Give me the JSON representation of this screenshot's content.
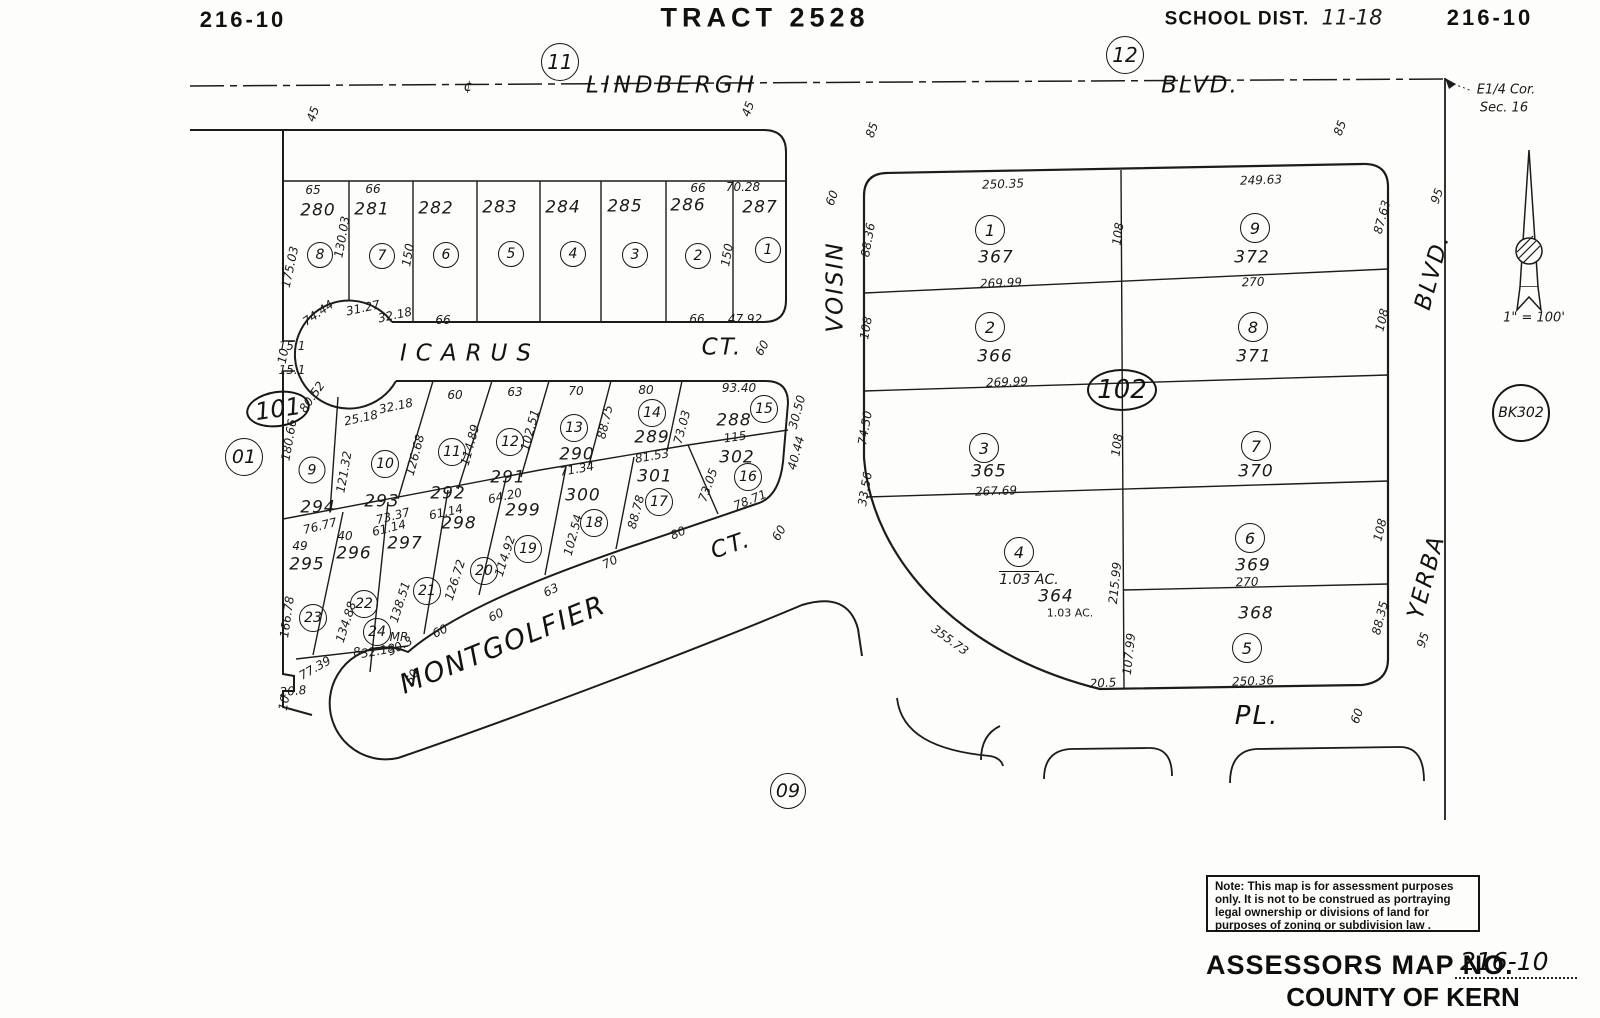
{
  "note_box": {
    "text": "Note: This map is for assessment purposes\nonly. It is not to be construed as portraying\nlegal ownership or divisions of land for\npurposes of zoning or subdivision law ."
  },
  "footer": {
    "assessors_label": "ASSESSORS MAP NO.",
    "map_no": "216-10",
    "county": "COUNTY OF KERN"
  },
  "annotations": [
    {
      "t": "216-10",
      "x": 243,
      "y": 20,
      "c": "hdr",
      "n": "sheet-number-left"
    },
    {
      "t": "TRACT 2528",
      "x": 765,
      "y": 18,
      "c": "hdr",
      "s": 27,
      "ls": 5,
      "n": "tract-title"
    },
    {
      "t": "SCHOOL DIST.",
      "x": 1237,
      "y": 19,
      "c": "hdr",
      "s": 19,
      "ls": 1,
      "n": "school-district-label"
    },
    {
      "t": "11-18",
      "x": 1352,
      "y": 18,
      "c": "hw",
      "n": "school-district-value"
    },
    {
      "t": "216-10",
      "x": 1490,
      "y": 18,
      "c": "hdr",
      "n": "sheet-number-right"
    },
    {
      "t": "E1/4 Cor.",
      "x": 1506,
      "y": 90,
      "c": "it13",
      "n": "corner-note-line1"
    },
    {
      "t": "Sec. 16",
      "x": 1504,
      "y": 108,
      "c": "it13",
      "n": "corner-note-line2"
    },
    {
      "t": "1\" = 100'",
      "x": 1534,
      "y": 318,
      "c": "it13",
      "n": "scale-note"
    },
    {
      "t": "LINDBERGH",
      "x": 672,
      "y": 86,
      "c": "st",
      "ls": 4,
      "n": "street-lindbergh"
    },
    {
      "t": "BLVD.",
      "x": 1200,
      "y": 86,
      "c": "st",
      "n": "street-lindbergh-blvd"
    },
    {
      "t": "¢",
      "x": 468,
      "y": 87,
      "c": "it14",
      "n": "centerline-symbol"
    },
    {
      "t": "ICARUS",
      "x": 470,
      "y": 354,
      "c": "st",
      "ls": 9,
      "n": "street-icarus"
    },
    {
      "t": "CT.",
      "x": 722,
      "y": 348,
      "c": "st",
      "n": "street-icarus-ct"
    },
    {
      "t": "MONTGOLFIER",
      "x": 503,
      "y": 645,
      "r": -22,
      "c": "st",
      "s": 27,
      "ls": 2,
      "n": "street-montgolfier"
    },
    {
      "t": "CT.",
      "x": 731,
      "y": 546,
      "r": -19,
      "c": "st",
      "n": "street-montgolfier-ct"
    },
    {
      "t": "VOISIN",
      "x": 836,
      "y": 287,
      "r": -90,
      "c": "st",
      "n": "street-voisin"
    },
    {
      "t": "YERBA",
      "x": 1427,
      "y": 577,
      "r": -75,
      "c": "st",
      "n": "street-yerba"
    },
    {
      "t": "BLVD.",
      "x": 1433,
      "y": 272,
      "r": -75,
      "c": "st",
      "n": "street-yerba-blvd"
    },
    {
      "t": "PL.",
      "x": 1257,
      "y": 716,
      "c": "st",
      "s": 26,
      "n": "street-pl"
    },
    {
      "t": "45",
      "x": 313,
      "y": 114,
      "r": -70
    },
    {
      "t": "45",
      "x": 748,
      "y": 109,
      "r": -70
    },
    {
      "t": "85",
      "x": 872,
      "y": 130,
      "r": -70
    },
    {
      "t": "85",
      "x": 1340,
      "y": 128,
      "r": -70
    },
    {
      "t": "95",
      "x": 1437,
      "y": 196,
      "r": -70
    },
    {
      "t": "95",
      "x": 1423,
      "y": 640,
      "r": -70
    },
    {
      "t": "60",
      "x": 832,
      "y": 198,
      "r": -70
    },
    {
      "t": "60",
      "x": 762,
      "y": 348,
      "r": -60
    },
    {
      "t": "60",
      "x": 779,
      "y": 533,
      "r": -60
    },
    {
      "t": "60",
      "x": 1357,
      "y": 716,
      "r": -70
    },
    {
      "t": "65",
      "x": 313,
      "y": 190
    },
    {
      "t": "66",
      "x": 373,
      "y": 189
    },
    {
      "t": "66",
      "x": 698,
      "y": 188
    },
    {
      "t": "70.28",
      "x": 743,
      "y": 187
    },
    {
      "t": "175.03",
      "x": 290,
      "y": 267,
      "r": -78
    },
    {
      "t": "130.03",
      "x": 342,
      "y": 237,
      "r": -80
    },
    {
      "t": "150",
      "x": 408,
      "y": 255,
      "r": -80
    },
    {
      "t": "150",
      "x": 727,
      "y": 255,
      "r": -80
    },
    {
      "t": "74.44",
      "x": 318,
      "y": 313,
      "r": -35
    },
    {
      "t": "31.27",
      "x": 363,
      "y": 308,
      "r": -12
    },
    {
      "t": "32.18",
      "x": 395,
      "y": 315,
      "r": -12
    },
    {
      "t": "66",
      "x": 443,
      "y": 320
    },
    {
      "t": "66",
      "x": 697,
      "y": 319
    },
    {
      "t": "47.92",
      "x": 745,
      "y": 319
    },
    {
      "t": "15.1",
      "x": 292,
      "y": 346
    },
    {
      "t": "10",
      "x": 283,
      "y": 356,
      "r": -80
    },
    {
      "t": "15.1",
      "x": 292,
      "y": 370
    },
    {
      "t": "80.52",
      "x": 312,
      "y": 397,
      "r": -55
    },
    {
      "t": "25.18",
      "x": 361,
      "y": 418,
      "r": -12
    },
    {
      "t": "32.18",
      "x": 396,
      "y": 406,
      "r": -12
    },
    {
      "t": "60",
      "x": 455,
      "y": 395
    },
    {
      "t": "63",
      "x": 515,
      "y": 392
    },
    {
      "t": "70",
      "x": 576,
      "y": 391
    },
    {
      "t": "80",
      "x": 646,
      "y": 390
    },
    {
      "t": "93.40",
      "x": 739,
      "y": 388
    },
    {
      "t": "180.66",
      "x": 289,
      "y": 440,
      "r": -80
    },
    {
      "t": "121.32",
      "x": 344,
      "y": 472,
      "r": -80
    },
    {
      "t": "126.68",
      "x": 415,
      "y": 455,
      "r": -75
    },
    {
      "t": "114.89",
      "x": 470,
      "y": 445,
      "r": -75
    },
    {
      "t": "102.51",
      "x": 530,
      "y": 430,
      "r": -75
    },
    {
      "t": "88.75",
      "x": 605,
      "y": 422,
      "r": -77
    },
    {
      "t": "73.03",
      "x": 682,
      "y": 427,
      "r": -75
    },
    {
      "t": "30.50",
      "x": 797,
      "y": 412,
      "r": -75
    },
    {
      "t": "40.44",
      "x": 796,
      "y": 453,
      "r": -75
    },
    {
      "t": "73.05",
      "x": 708,
      "y": 485,
      "r": -70
    },
    {
      "t": "88.78",
      "x": 636,
      "y": 512,
      "r": -75
    },
    {
      "t": "102.54",
      "x": 573,
      "y": 535,
      "r": -75
    },
    {
      "t": "114.92",
      "x": 505,
      "y": 556,
      "r": -72
    },
    {
      "t": "126.72",
      "x": 455,
      "y": 580,
      "r": -72
    },
    {
      "t": "138.51",
      "x": 400,
      "y": 602,
      "r": -72
    },
    {
      "t": "134.88",
      "x": 346,
      "y": 622,
      "r": -72
    },
    {
      "t": "166.78",
      "x": 287,
      "y": 617,
      "r": -82
    },
    {
      "t": "115",
      "x": 735,
      "y": 437,
      "r": -8
    },
    {
      "t": "81.53",
      "x": 652,
      "y": 456,
      "r": -10
    },
    {
      "t": "71.34",
      "x": 577,
      "y": 469,
      "r": -10
    },
    {
      "t": "64.20",
      "x": 505,
      "y": 496,
      "r": -12
    },
    {
      "t": "61.14",
      "x": 446,
      "y": 512,
      "r": -12
    },
    {
      "t": "73.37",
      "x": 393,
      "y": 516,
      "r": -14
    },
    {
      "t": "61.14",
      "x": 389,
      "y": 528,
      "r": -14
    },
    {
      "t": "76.77",
      "x": 320,
      "y": 526,
      "r": -14
    },
    {
      "t": "49",
      "x": 300,
      "y": 546
    },
    {
      "t": "40",
      "x": 345,
      "y": 536
    },
    {
      "t": "78.71",
      "x": 750,
      "y": 500,
      "r": -22
    },
    {
      "t": "80",
      "x": 678,
      "y": 533,
      "r": -24
    },
    {
      "t": "70",
      "x": 610,
      "y": 562,
      "r": -26
    },
    {
      "t": "63",
      "x": 551,
      "y": 590,
      "r": -26
    },
    {
      "t": "60",
      "x": 496,
      "y": 615,
      "r": -26
    },
    {
      "t": "60",
      "x": 440,
      "y": 631,
      "r": -26
    },
    {
      "t": "8",
      "x": 357,
      "y": 652,
      "r": -10
    },
    {
      "t": "32.18",
      "x": 378,
      "y": 651,
      "r": -10
    },
    {
      "t": "30.3",
      "x": 400,
      "y": 646,
      "r": -28
    },
    {
      "t": "77.39",
      "x": 315,
      "y": 668,
      "r": -30
    },
    {
      "t": "20.8",
      "x": 293,
      "y": 691,
      "r": -5
    },
    {
      "t": "10",
      "x": 284,
      "y": 703,
      "r": -80
    },
    {
      "t": "60",
      "x": 412,
      "y": 677,
      "r": -62
    },
    {
      "t": "MR",
      "x": 399,
      "y": 637,
      "c": "it12",
      "n": "mr-note"
    },
    {
      "t": "250.35",
      "x": 1003,
      "y": 184,
      "r": -2
    },
    {
      "t": "249.63",
      "x": 1261,
      "y": 180,
      "r": -2
    },
    {
      "t": "88.36",
      "x": 868,
      "y": 240,
      "r": -80
    },
    {
      "t": "108",
      "x": 866,
      "y": 328,
      "r": -80
    },
    {
      "t": "74.50",
      "x": 865,
      "y": 428,
      "r": -80
    },
    {
      "t": "33.56",
      "x": 865,
      "y": 489,
      "r": -80
    },
    {
      "t": "108",
      "x": 1118,
      "y": 234,
      "r": -82
    },
    {
      "t": "108",
      "x": 1117,
      "y": 445,
      "r": -82
    },
    {
      "t": "215.99",
      "x": 1115,
      "y": 583,
      "r": -84
    },
    {
      "t": "107.99",
      "x": 1129,
      "y": 654,
      "r": -84
    },
    {
      "t": "87.63",
      "x": 1382,
      "y": 217,
      "r": -75
    },
    {
      "t": "108",
      "x": 1382,
      "y": 320,
      "r": -76
    },
    {
      "t": "108",
      "x": 1380,
      "y": 530,
      "r": -76
    },
    {
      "t": "88.35",
      "x": 1380,
      "y": 618,
      "r": -76
    },
    {
      "t": "269.99",
      "x": 1001,
      "y": 283,
      "r": -2
    },
    {
      "t": "269.99",
      "x": 1007,
      "y": 382,
      "r": -2
    },
    {
      "t": "267.69",
      "x": 996,
      "y": 491,
      "r": -2
    },
    {
      "t": "270",
      "x": 1253,
      "y": 282,
      "r": -2
    },
    {
      "t": "270",
      "x": 1247,
      "y": 582,
      "r": -2
    },
    {
      "t": "355.73",
      "x": 950,
      "y": 640,
      "r": 36
    },
    {
      "t": "20.5",
      "x": 1103,
      "y": 683,
      "r": -3
    },
    {
      "t": "250.36",
      "x": 1253,
      "y": 681,
      "r": -2
    },
    {
      "t": "1.03 AC.",
      "x": 1029,
      "y": 580,
      "c": "it14",
      "n": "lot-364-acreage"
    },
    {
      "t": "1.03 AC.",
      "x": 1070,
      "y": 613,
      "c": "pl11",
      "n": "lot-364-acreage-2"
    },
    {
      "t": "280",
      "x": 318,
      "y": 211,
      "c": "lot"
    },
    {
      "t": "281",
      "x": 372,
      "y": 210,
      "c": "lot"
    },
    {
      "t": "282",
      "x": 436,
      "y": 209,
      "c": "lot"
    },
    {
      "t": "283",
      "x": 500,
      "y": 208,
      "c": "lot"
    },
    {
      "t": "284",
      "x": 563,
      "y": 208,
      "c": "lot"
    },
    {
      "t": "285",
      "x": 625,
      "y": 207,
      "c": "lot"
    },
    {
      "t": "286",
      "x": 688,
      "y": 206,
      "c": "lot"
    },
    {
      "t": "287",
      "x": 760,
      "y": 208,
      "c": "lot"
    },
    {
      "t": "294",
      "x": 318,
      "y": 508,
      "c": "lot"
    },
    {
      "t": "293",
      "x": 382,
      "y": 502,
      "c": "lot"
    },
    {
      "t": "292",
      "x": 448,
      "y": 494,
      "c": "lot"
    },
    {
      "t": "291",
      "x": 508,
      "y": 478,
      "c": "lot"
    },
    {
      "t": "290",
      "x": 577,
      "y": 455,
      "c": "lot"
    },
    {
      "t": "289",
      "x": 652,
      "y": 438,
      "c": "lot"
    },
    {
      "t": "288",
      "x": 734,
      "y": 421,
      "c": "lot"
    },
    {
      "t": "302",
      "x": 737,
      "y": 458,
      "c": "lot"
    },
    {
      "t": "301",
      "x": 655,
      "y": 477,
      "c": "lot"
    },
    {
      "t": "300",
      "x": 583,
      "y": 496,
      "c": "lot"
    },
    {
      "t": "299",
      "x": 523,
      "y": 511,
      "c": "lot"
    },
    {
      "t": "298",
      "x": 459,
      "y": 524,
      "c": "lot"
    },
    {
      "t": "297",
      "x": 405,
      "y": 544,
      "c": "lot"
    },
    {
      "t": "296",
      "x": 354,
      "y": 554,
      "c": "lot"
    },
    {
      "t": "295",
      "x": 307,
      "y": 565,
      "c": "lot"
    },
    {
      "t": "367",
      "x": 996,
      "y": 258,
      "c": "lot"
    },
    {
      "t": "366",
      "x": 995,
      "y": 357,
      "c": "lot"
    },
    {
      "t": "365",
      "x": 989,
      "y": 472,
      "c": "lot"
    },
    {
      "t": "364",
      "x": 1056,
      "y": 597,
      "c": "lot"
    },
    {
      "t": "372",
      "x": 1252,
      "y": 258,
      "c": "lot"
    },
    {
      "t": "371",
      "x": 1254,
      "y": 357,
      "c": "lot"
    },
    {
      "t": "370",
      "x": 1256,
      "y": 472,
      "c": "lot"
    },
    {
      "t": "369",
      "x": 1253,
      "y": 566,
      "c": "lot"
    },
    {
      "t": "368",
      "x": 1256,
      "y": 614,
      "c": "lot"
    }
  ],
  "circles": [
    {
      "t": "8",
      "x": 320,
      "y": 255,
      "d": 26,
      "s": 14
    },
    {
      "t": "7",
      "x": 382,
      "y": 256,
      "d": 26,
      "s": 14
    },
    {
      "t": "6",
      "x": 446,
      "y": 255,
      "d": 26,
      "s": 14
    },
    {
      "t": "5",
      "x": 511,
      "y": 254,
      "d": 26,
      "s": 14
    },
    {
      "t": "4",
      "x": 573,
      "y": 254,
      "d": 26,
      "s": 14
    },
    {
      "t": "3",
      "x": 635,
      "y": 255,
      "d": 26,
      "s": 14
    },
    {
      "t": "2",
      "x": 698,
      "y": 256,
      "d": 26,
      "s": 14
    },
    {
      "t": "1",
      "x": 768,
      "y": 250,
      "d": 26,
      "s": 14
    },
    {
      "t": "9",
      "x": 312,
      "y": 470,
      "d": 27,
      "s": 14
    },
    {
      "t": "10",
      "x": 385,
      "y": 464,
      "d": 28,
      "s": 14
    },
    {
      "t": "11",
      "x": 452,
      "y": 452,
      "d": 28,
      "s": 14
    },
    {
      "t": "12",
      "x": 510,
      "y": 442,
      "d": 28,
      "s": 14
    },
    {
      "t": "13",
      "x": 574,
      "y": 428,
      "d": 28,
      "s": 14
    },
    {
      "t": "14",
      "x": 652,
      "y": 413,
      "d": 28,
      "s": 14
    },
    {
      "t": "15",
      "x": 764,
      "y": 409,
      "d": 28,
      "s": 14
    },
    {
      "t": "16",
      "x": 748,
      "y": 477,
      "d": 28,
      "s": 14
    },
    {
      "t": "17",
      "x": 659,
      "y": 502,
      "d": 28,
      "s": 14
    },
    {
      "t": "18",
      "x": 594,
      "y": 523,
      "d": 28,
      "s": 14
    },
    {
      "t": "19",
      "x": 528,
      "y": 549,
      "d": 28,
      "s": 14
    },
    {
      "t": "20",
      "x": 484,
      "y": 571,
      "d": 28,
      "s": 14
    },
    {
      "t": "21",
      "x": 427,
      "y": 591,
      "d": 28,
      "s": 14
    },
    {
      "t": "22",
      "x": 364,
      "y": 604,
      "d": 28,
      "s": 14
    },
    {
      "t": "23",
      "x": 313,
      "y": 618,
      "d": 28,
      "s": 14
    },
    {
      "t": "24",
      "x": 377,
      "y": 632,
      "d": 28,
      "s": 14
    },
    {
      "t": "1",
      "x": 990,
      "y": 230,
      "d": 30,
      "s": 16
    },
    {
      "t": "2",
      "x": 990,
      "y": 327,
      "d": 30,
      "s": 16
    },
    {
      "t": "3",
      "x": 984,
      "y": 448,
      "d": 30,
      "s": 16
    },
    {
      "t": "4",
      "x": 1019,
      "y": 552,
      "d": 30,
      "s": 16,
      "u": 1
    },
    {
      "t": "5",
      "x": 1247,
      "y": 648,
      "d": 30,
      "s": 16
    },
    {
      "t": "6",
      "x": 1250,
      "y": 538,
      "d": 30,
      "s": 16
    },
    {
      "t": "7",
      "x": 1256,
      "y": 446,
      "d": 30,
      "s": 16
    },
    {
      "t": "8",
      "x": 1253,
      "y": 327,
      "d": 30,
      "s": 16
    },
    {
      "t": "9",
      "x": 1255,
      "y": 228,
      "d": 30,
      "s": 16
    },
    {
      "t": "11",
      "x": 560,
      "y": 62,
      "d": 38,
      "s": 20,
      "n": "ref-circle-11"
    },
    {
      "t": "12",
      "x": 1125,
      "y": 55,
      "d": 38,
      "s": 20,
      "n": "ref-circle-12"
    },
    {
      "t": "01",
      "x": 244,
      "y": 457,
      "d": 38,
      "s": 19,
      "n": "ref-circle-01"
    },
    {
      "t": "09",
      "x": 788,
      "y": 791,
      "d": 36,
      "s": 19,
      "n": "ref-circle-09"
    },
    {
      "t": "BK302",
      "x": 1521,
      "y": 413,
      "d": 58,
      "s": 14,
      "n": "book-ref-circle",
      "b": 1
    },
    {
      "t": "101",
      "x": 278,
      "y": 409,
      "w": 64,
      "h": 36,
      "s": 24,
      "r": -8,
      "n": "block-oval-101",
      "b": 1
    },
    {
      "t": "102",
      "x": 1122,
      "y": 390,
      "w": 70,
      "h": 42,
      "s": 26,
      "n": "block-oval-102",
      "b": 1
    }
  ]
}
